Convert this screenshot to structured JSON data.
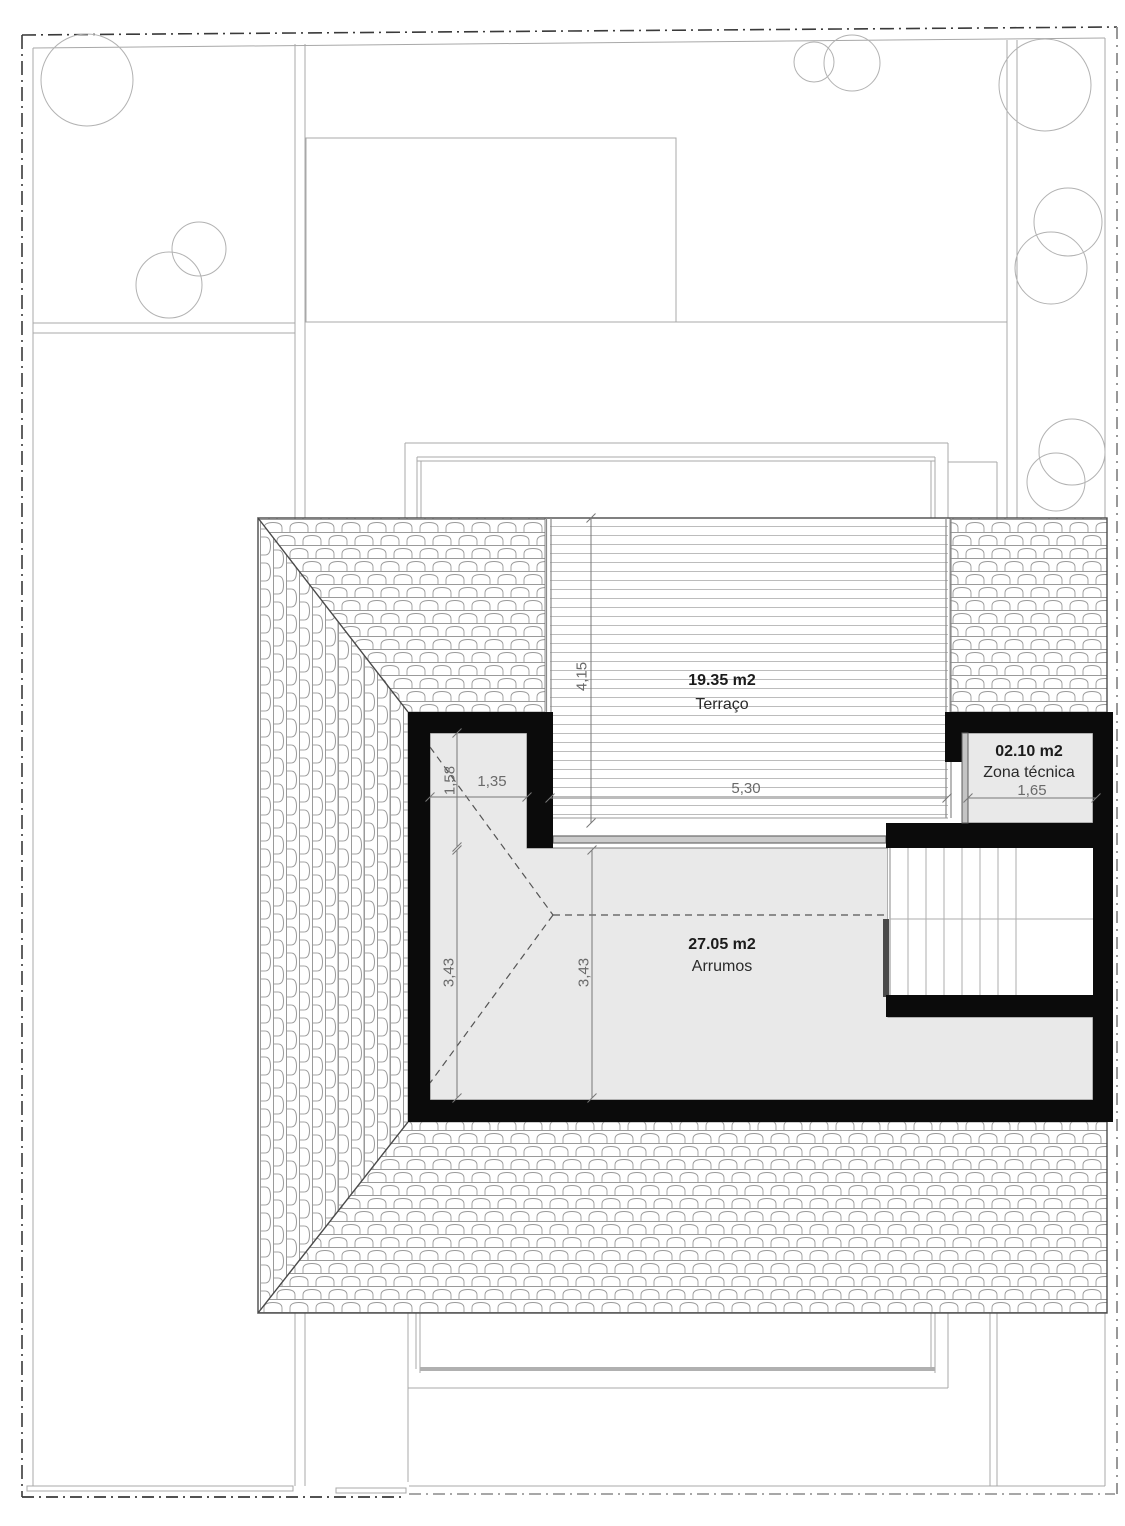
{
  "rooms": [
    {
      "id": "terraco",
      "area_label": "19.35 m2",
      "name": "Terraço"
    },
    {
      "id": "zona_tecnica",
      "area_label": "02.10 m2",
      "name": "Zona técnica"
    },
    {
      "id": "arrumos",
      "area_label": "27.05 m2",
      "name": "Arrumos"
    }
  ],
  "dimensions": [
    {
      "id": "terrace_depth",
      "value": "4,15"
    },
    {
      "id": "terrace_width",
      "value": "5,30"
    },
    {
      "id": "notch_width",
      "value": "1,35"
    },
    {
      "id": "notch_depth",
      "value": "1,58"
    },
    {
      "id": "arrumos_depth_left",
      "value": "3,43"
    },
    {
      "id": "arrumos_depth_mid",
      "value": "3,43"
    },
    {
      "id": "zona_width",
      "value": "1,65"
    }
  ],
  "colors": {
    "wall": "#0b0b0b",
    "room_fill": "#e9e9e9",
    "site_line": "#a8a8a8",
    "tile_line": "#9a9a9a",
    "dimension": "#6a6a6a"
  }
}
